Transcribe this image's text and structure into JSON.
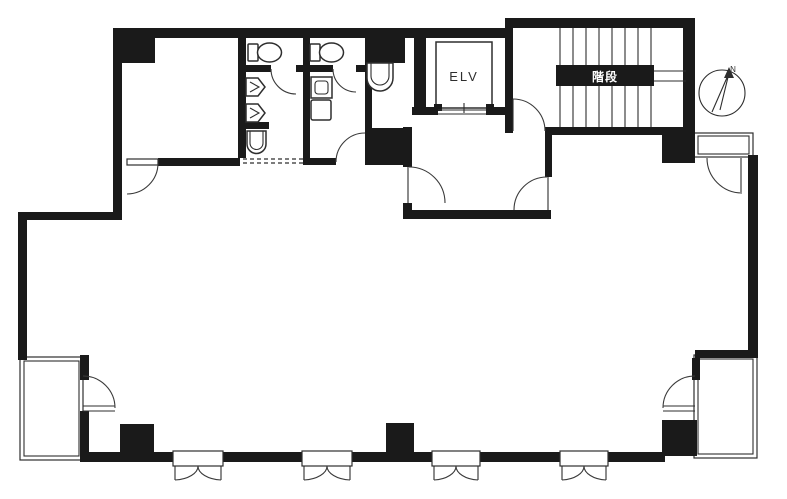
{
  "title": "building-floor-plan",
  "labels": {
    "elevator": "ELV",
    "stairs": "階段",
    "compass_north": "N"
  },
  "colors": {
    "wall": "#1a1a1a",
    "line": "#2e2e2e",
    "background": "#ffffff"
  }
}
